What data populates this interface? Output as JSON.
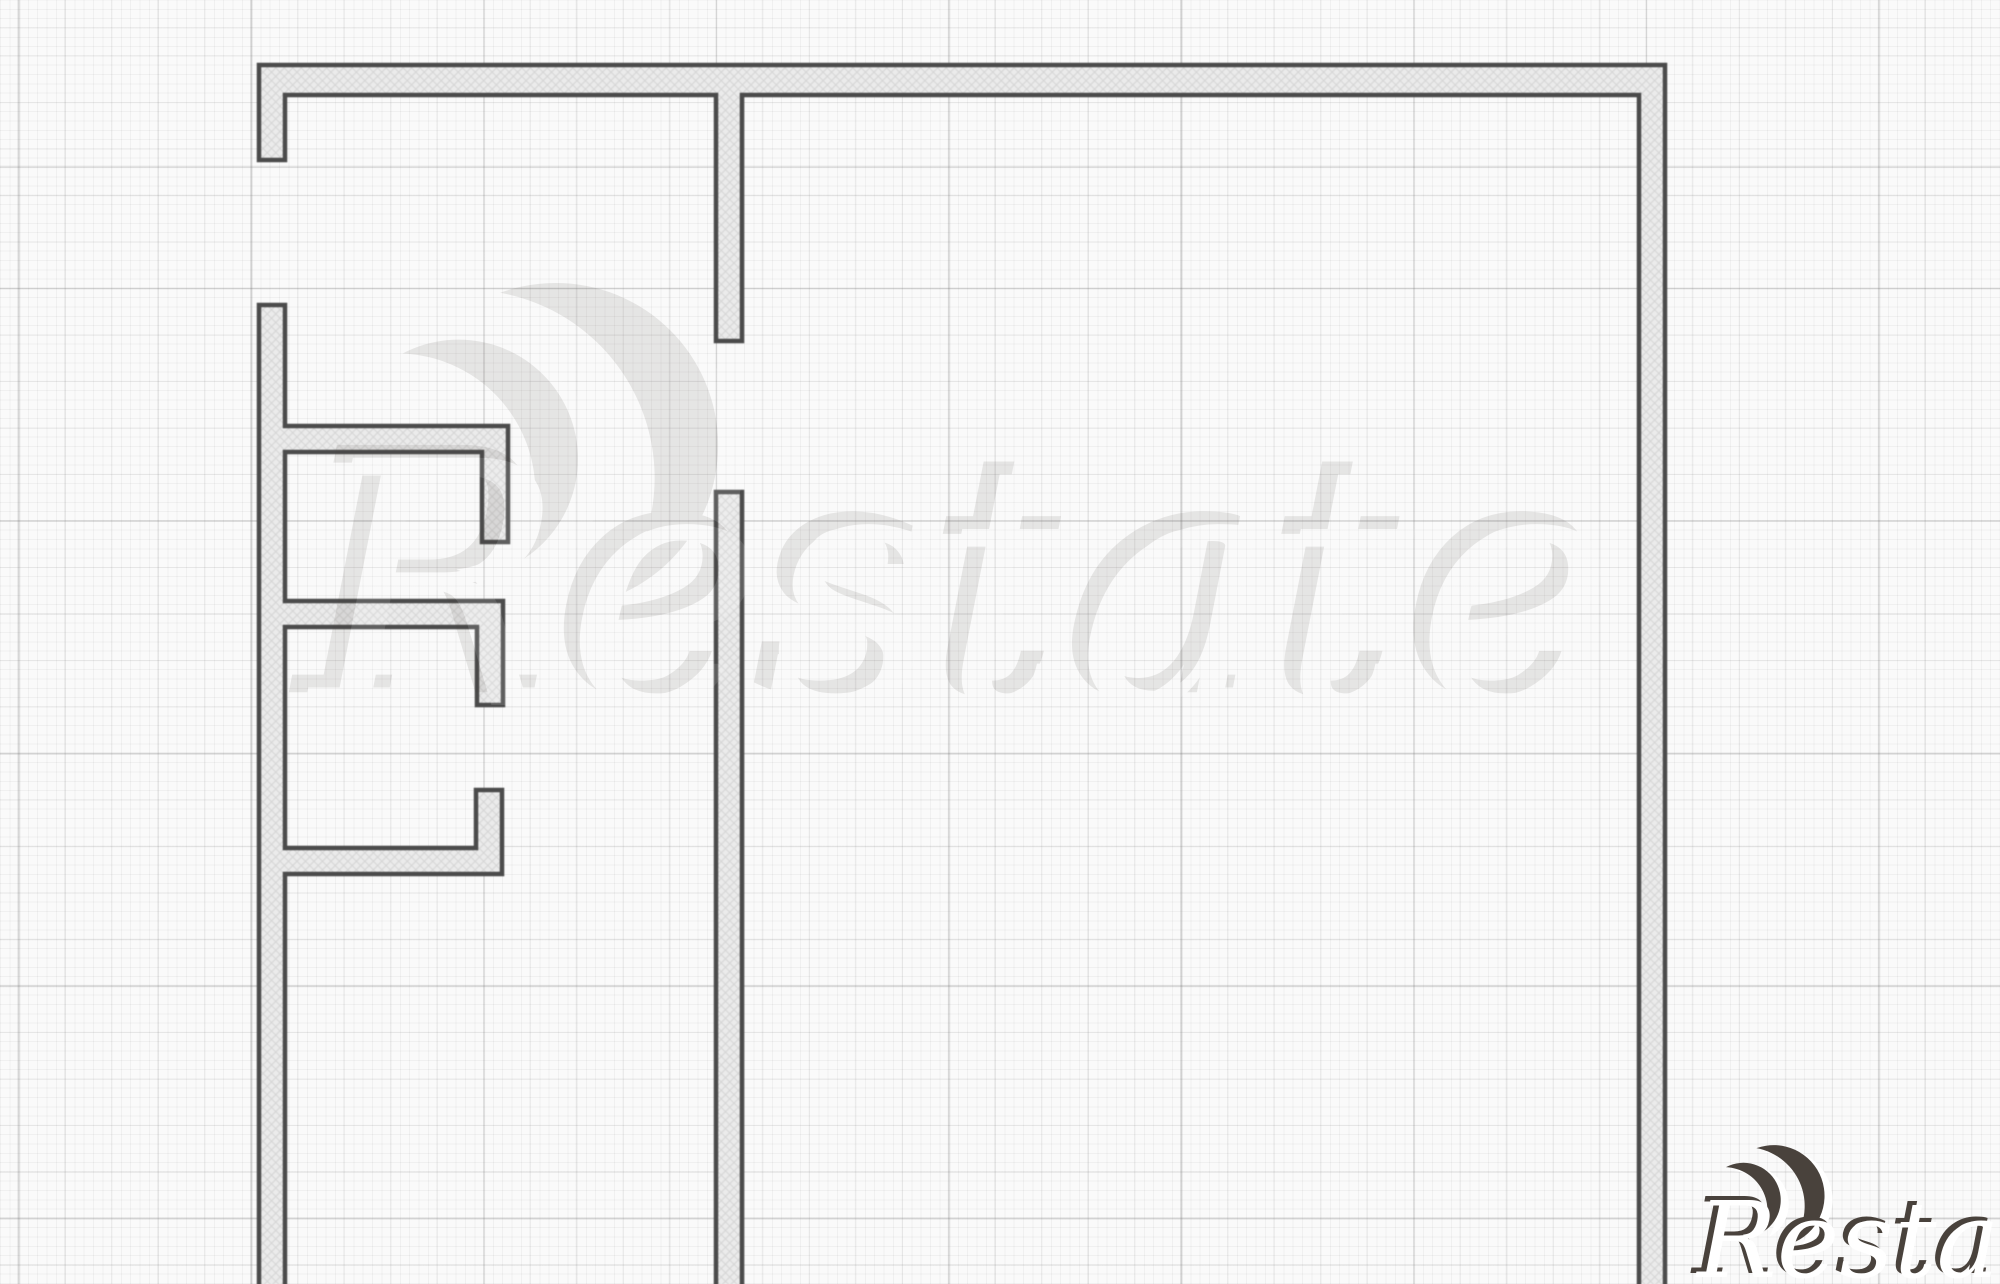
{
  "canvas": {
    "width": 2000,
    "height": 1284,
    "background_color": "#fafafa",
    "grid": {
      "fine_spacing_px": 9.3,
      "medium_spacing_px": 46.5,
      "major_spacing_px": 232.5,
      "fine_color": "rgba(120,120,120,0.08)",
      "medium_color": "rgba(120,120,120,0.12)",
      "major_color": "rgba(108,108,108,0.16)"
    }
  },
  "plan": {
    "wall_stroke_color": "#4b4b4b",
    "wall_stroke_width": 4.5,
    "wall_fill_base": "#ebebeb",
    "wall_hatch_color": "#d5d5d5",
    "wall_thickness_px": 26,
    "segments": [
      {
        "name": "outer-shell-top-right-and-entry-stub",
        "points": [
          [
            259,
            65
          ],
          [
            1665,
            65
          ],
          [
            1665,
            1290
          ],
          [
            1639,
            1290
          ],
          [
            1639,
            95
          ],
          [
            742,
            95
          ],
          [
            742,
            341
          ],
          [
            716,
            341
          ],
          [
            716,
            95
          ],
          [
            285,
            95
          ],
          [
            285,
            160
          ],
          [
            259,
            160
          ]
        ]
      },
      {
        "name": "left-wall-with-three-partitions",
        "points": [
          [
            259,
            305
          ],
          [
            285,
            305
          ],
          [
            285,
            426
          ],
          [
            508,
            426
          ],
          [
            508,
            542
          ],
          [
            482,
            542
          ],
          [
            482,
            452
          ],
          [
            285,
            452
          ],
          [
            285,
            601
          ],
          [
            503,
            601
          ],
          [
            503,
            705
          ],
          [
            477,
            705
          ],
          [
            477,
            627
          ],
          [
            285,
            627
          ],
          [
            285,
            848
          ],
          [
            476,
            848
          ],
          [
            476,
            790
          ],
          [
            502,
            790
          ],
          [
            502,
            874
          ],
          [
            285,
            874
          ],
          [
            285,
            1290
          ],
          [
            259,
            1290
          ]
        ]
      },
      {
        "name": "central-partition-wall",
        "points": [
          [
            716,
            492
          ],
          [
            742,
            492
          ],
          [
            742,
            1290
          ],
          [
            716,
            1290
          ]
        ]
      }
    ]
  },
  "watermark": {
    "text": "Restate",
    "logo": "double-crescent-logo",
    "fill_color": "#ffffff",
    "shadow_color": "#49423c",
    "corner": {
      "x": 1697,
      "y": 1277,
      "font_size": 106
    },
    "ghost": {
      "x": 310,
      "y": 705,
      "scale": 3.2,
      "opacity": 0.11
    },
    "crescents": [
      {
        "dx": 46,
        "dy": -76,
        "scale": 0.72,
        "rotate": -18
      },
      {
        "dx": 76,
        "dy": -80,
        "scale": 0.98,
        "rotate": -10
      }
    ]
  }
}
